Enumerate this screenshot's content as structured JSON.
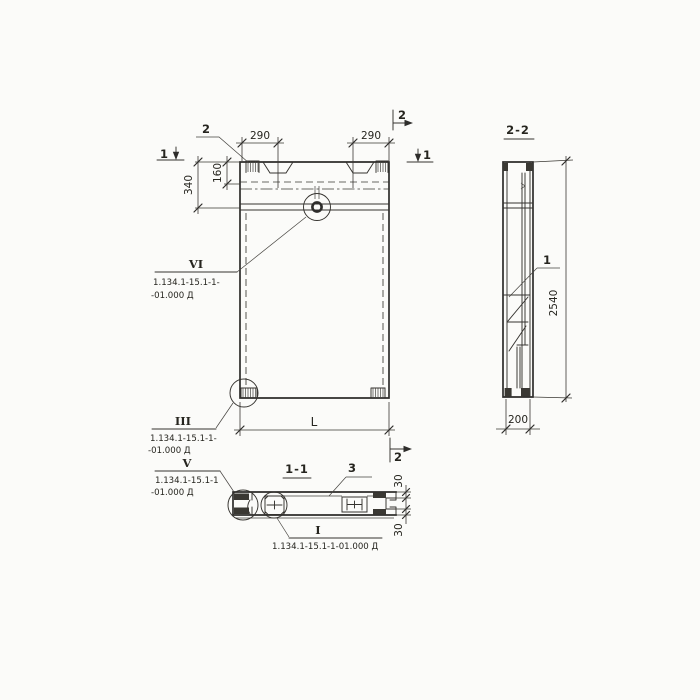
{
  "palette": {
    "paper": "#fbfbf9",
    "ink": "#2e2d2b"
  },
  "front_view": {
    "callout_top_left": "2",
    "cut_marks": {
      "left": "1",
      "right": "1",
      "top_right": "2",
      "bottom_right": "2"
    },
    "dims": {
      "left_290": "290",
      "right_290": "290",
      "v_340": "340",
      "v_160": "160",
      "length": "L"
    },
    "detail_vi": {
      "label": "VI",
      "doc1": "1.134.1-15.1-1-",
      "doc2": "-01.000 Д"
    },
    "detail_iii": {
      "label": "III",
      "doc1": "1.134.1-15.1-1-",
      "doc2": "-01.000 Д"
    }
  },
  "section_2_2": {
    "title": "2-2",
    "callout_1": "1",
    "dims": {
      "height": "2540",
      "width": "200"
    }
  },
  "section_1_1": {
    "title": "1-1",
    "callout_3": "3",
    "dims": {
      "flange_top": "30",
      "flange_bottom": "30"
    },
    "detail_v": {
      "label": "V",
      "doc1": "1.134.1-15.1-1",
      "doc2": "-01.000 Д"
    },
    "detail_i": {
      "label": "I",
      "doc": "1.134.1-15.1-1-01.000 Д"
    }
  }
}
